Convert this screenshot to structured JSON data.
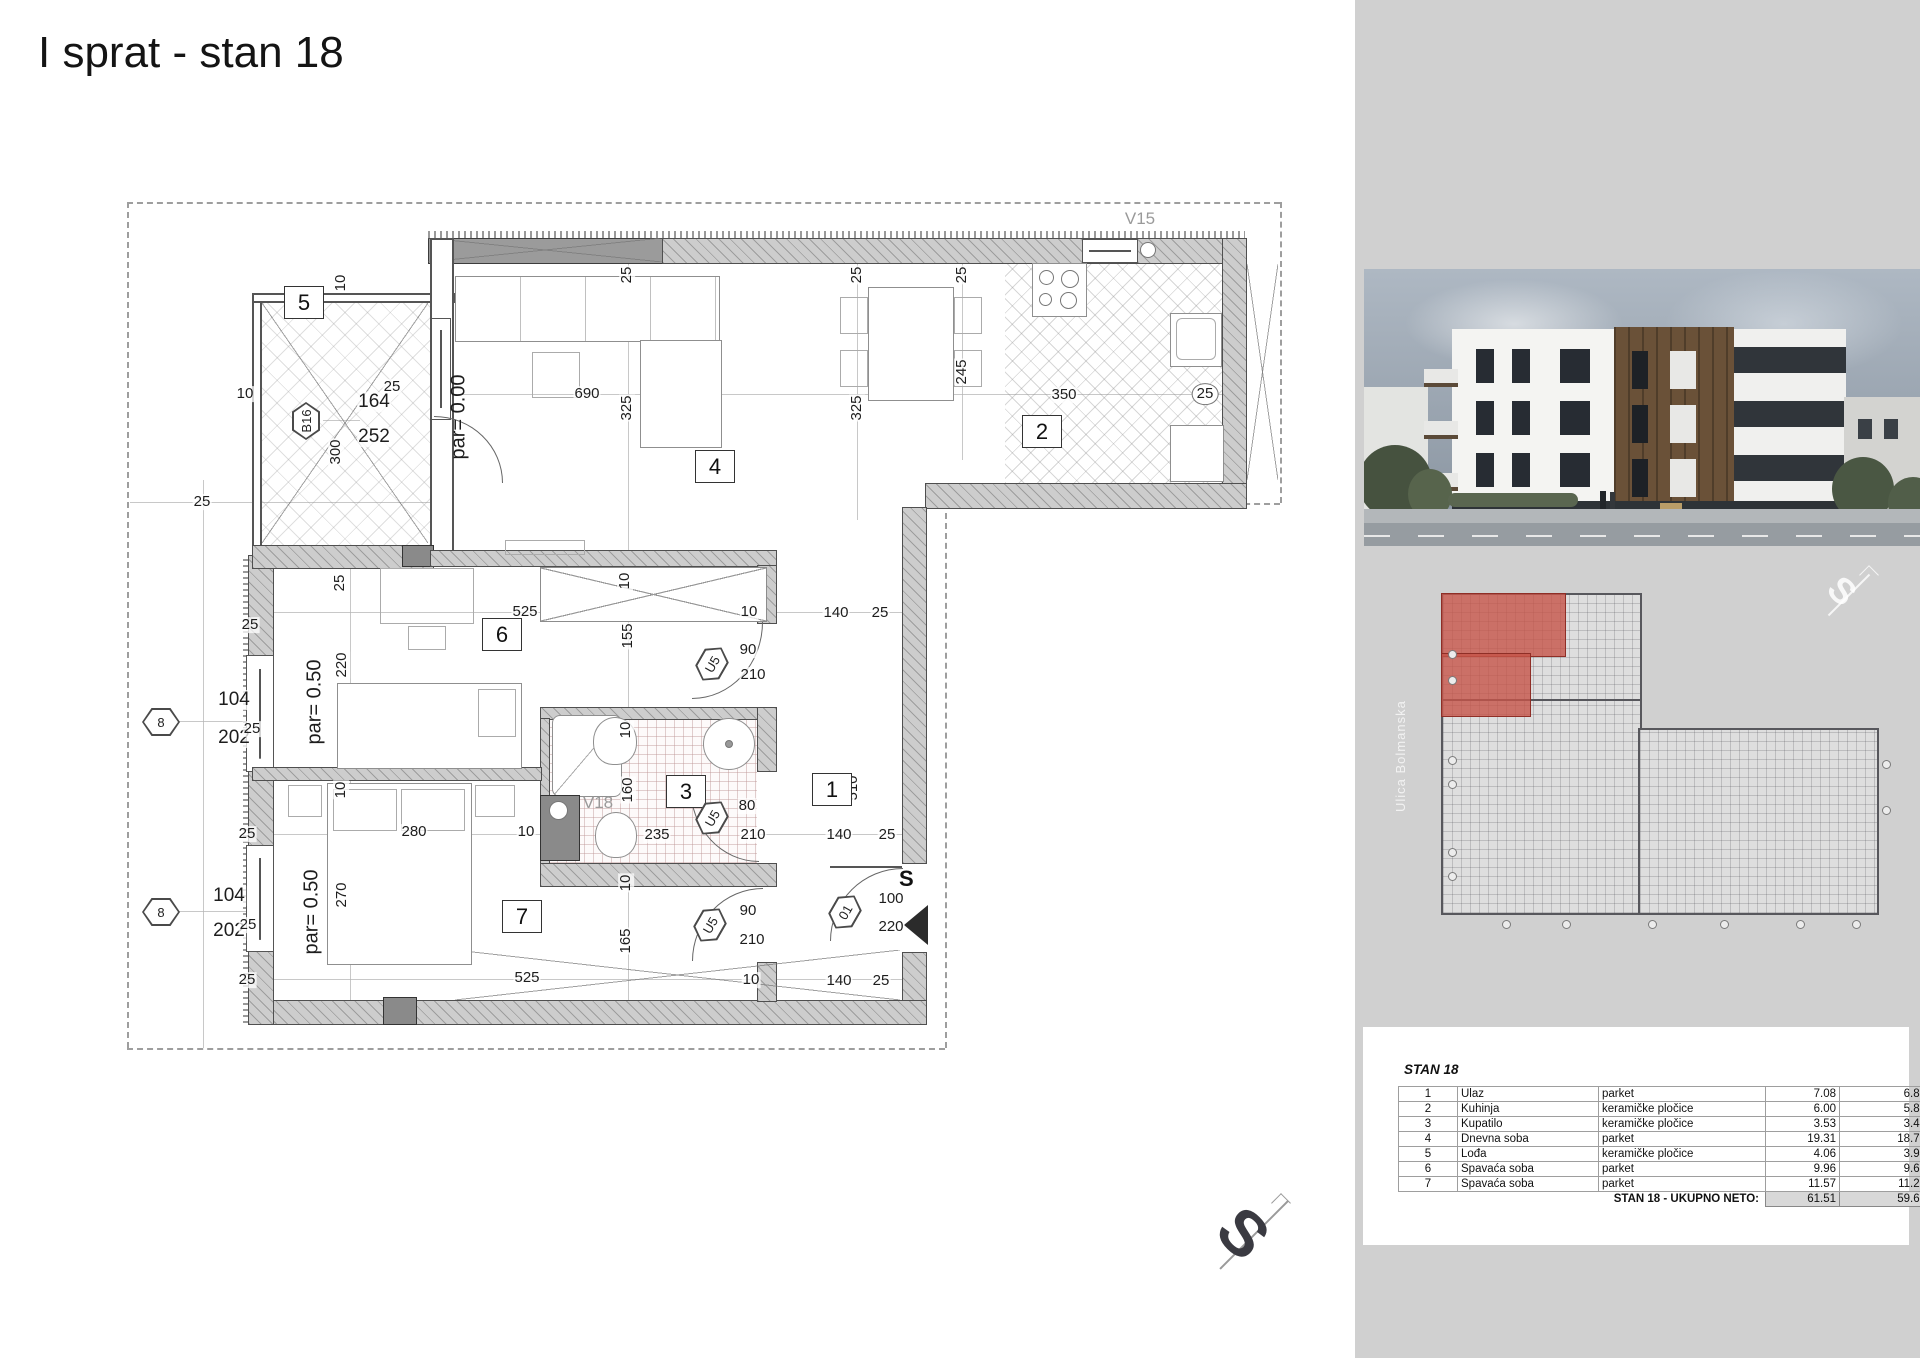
{
  "title": "I sprat - stan 18",
  "colors": {
    "highlight_red": "#c5544a",
    "panel_gray": "#d0d0d0"
  },
  "plan": {
    "window_label_top": "V15",
    "window_label_bath": "V18",
    "entry_letter": "S",
    "rooms": [
      {
        "n": "5",
        "x": 303,
        "y": 302
      },
      {
        "n": "4",
        "x": 714,
        "y": 466
      },
      {
        "n": "2",
        "x": 1041,
        "y": 431
      },
      {
        "n": "6",
        "x": 501,
        "y": 634
      },
      {
        "n": "3",
        "x": 685,
        "y": 791
      },
      {
        "n": "1",
        "x": 831,
        "y": 789
      },
      {
        "n": "7",
        "x": 521,
        "y": 916
      }
    ],
    "hexes": [
      {
        "t": "B16",
        "x": 306,
        "y": 421,
        "r": -90
      },
      {
        "t": "8",
        "x": 161,
        "y": 722,
        "r": 0
      },
      {
        "t": "8",
        "x": 161,
        "y": 912,
        "r": 0
      },
      {
        "t": "U5",
        "x": 712,
        "y": 664,
        "r": -60
      },
      {
        "t": "U5",
        "x": 712,
        "y": 818,
        "r": -60
      },
      {
        "t": "U5",
        "x": 710,
        "y": 925,
        "r": -60
      },
      {
        "t": "01",
        "x": 845,
        "y": 912,
        "r": -60
      }
    ],
    "dims": [
      {
        "t": "10",
        "x": 245,
        "y": 394,
        "r": 0
      },
      {
        "t": "10",
        "x": 341,
        "y": 283,
        "r": -90
      },
      {
        "t": "25",
        "x": 392,
        "y": 387,
        "r": 0
      },
      {
        "t": "164",
        "x": 374,
        "y": 402,
        "r": 0,
        "k": "big"
      },
      {
        "t": "252",
        "x": 374,
        "y": 437,
        "r": 0,
        "k": "big"
      },
      {
        "t": "300",
        "x": 336,
        "y": 452,
        "r": -90
      },
      {
        "t": "690",
        "x": 587,
        "y": 394,
        "r": 0
      },
      {
        "t": "25",
        "x": 627,
        "y": 275,
        "r": -90
      },
      {
        "t": "325",
        "x": 627,
        "y": 408,
        "r": -90
      },
      {
        "t": "25",
        "x": 857,
        "y": 275,
        "r": -90
      },
      {
        "t": "325",
        "x": 857,
        "y": 408,
        "r": -90
      },
      {
        "t": "25",
        "x": 962,
        "y": 275,
        "r": -90
      },
      {
        "t": "245",
        "x": 962,
        "y": 372,
        "r": -90
      },
      {
        "t": "350",
        "x": 1064,
        "y": 395,
        "r": 0
      },
      {
        "t": "25",
        "x": 1205,
        "y": 394,
        "r": 0,
        "k": "circ"
      },
      {
        "t": "25",
        "x": 202,
        "y": 502,
        "r": 0
      },
      {
        "t": "525",
        "x": 525,
        "y": 612,
        "r": 0
      },
      {
        "t": "10",
        "x": 749,
        "y": 612,
        "r": 0
      },
      {
        "t": "140",
        "x": 836,
        "y": 613,
        "r": 0
      },
      {
        "t": "25",
        "x": 880,
        "y": 613,
        "r": 0
      },
      {
        "t": "25",
        "x": 340,
        "y": 583,
        "r": -90
      },
      {
        "t": "10",
        "x": 625,
        "y": 581,
        "r": -90
      },
      {
        "t": "155",
        "x": 628,
        "y": 636,
        "r": -90
      },
      {
        "t": "220",
        "x": 342,
        "y": 665,
        "r": -90
      },
      {
        "t": "25",
        "x": 250,
        "y": 625,
        "r": 0
      },
      {
        "t": "104",
        "x": 234,
        "y": 700,
        "r": 0,
        "k": "big"
      },
      {
        "t": "202",
        "x": 234,
        "y": 738,
        "r": 0,
        "k": "big"
      },
      {
        "t": "25",
        "x": 252,
        "y": 729,
        "r": 0
      },
      {
        "t": "90",
        "x": 748,
        "y": 650,
        "r": 0
      },
      {
        "t": "210",
        "x": 753,
        "y": 675,
        "r": 0
      },
      {
        "t": "10",
        "x": 626,
        "y": 730,
        "r": -90
      },
      {
        "t": "160",
        "x": 628,
        "y": 790,
        "r": -90
      },
      {
        "t": "235",
        "x": 657,
        "y": 835,
        "r": 0
      },
      {
        "t": "80",
        "x": 747,
        "y": 806,
        "r": 0
      },
      {
        "t": "210",
        "x": 753,
        "y": 835,
        "r": 0
      },
      {
        "t": "280",
        "x": 414,
        "y": 832,
        "r": 0
      },
      {
        "t": "10",
        "x": 526,
        "y": 832,
        "r": 0
      },
      {
        "t": "140",
        "x": 839,
        "y": 835,
        "r": 0
      },
      {
        "t": "25",
        "x": 887,
        "y": 835,
        "r": 0
      },
      {
        "t": "270",
        "x": 342,
        "y": 895,
        "r": -90
      },
      {
        "t": "10",
        "x": 341,
        "y": 790,
        "r": -90
      },
      {
        "t": "104",
        "x": 229,
        "y": 896,
        "r": 0,
        "k": "big"
      },
      {
        "t": "202",
        "x": 229,
        "y": 931,
        "r": 0,
        "k": "big"
      },
      {
        "t": "25",
        "x": 248,
        "y": 925,
        "r": 0
      },
      {
        "t": "25",
        "x": 247,
        "y": 834,
        "r": 0
      },
      {
        "t": "90",
        "x": 748,
        "y": 911,
        "r": 0
      },
      {
        "t": "210",
        "x": 752,
        "y": 940,
        "r": 0
      },
      {
        "t": "100",
        "x": 891,
        "y": 899,
        "r": 0
      },
      {
        "t": "220",
        "x": 891,
        "y": 927,
        "r": 0
      },
      {
        "t": "10",
        "x": 626,
        "y": 883,
        "r": -90
      },
      {
        "t": "165",
        "x": 626,
        "y": 941,
        "r": -90
      },
      {
        "t": "525",
        "x": 527,
        "y": 978,
        "r": 0
      },
      {
        "t": "10",
        "x": 751,
        "y": 980,
        "r": 0
      },
      {
        "t": "140",
        "x": 839,
        "y": 981,
        "r": 0
      },
      {
        "t": "25",
        "x": 881,
        "y": 981,
        "r": 0
      },
      {
        "t": "25",
        "x": 247,
        "y": 980,
        "r": 0
      },
      {
        "t": "510",
        "x": 853,
        "y": 788,
        "r": -90
      },
      {
        "t": "par= 0.00",
        "x": 459,
        "y": 417,
        "r": -90,
        "k": "par"
      },
      {
        "t": "par= 0.50",
        "x": 315,
        "y": 702,
        "r": -90,
        "k": "par"
      },
      {
        "t": "par= 0.50",
        "x": 312,
        "y": 912,
        "r": -90,
        "k": "par"
      }
    ]
  },
  "compass": {
    "letter": "S"
  },
  "side": {
    "street": "Ulica Bolmanska",
    "mini_compass": "S",
    "table": {
      "title": "STAN 18",
      "rows": [
        [
          "1",
          "Ulaz",
          "parket",
          "7.08",
          "6.87"
        ],
        [
          "2",
          "Kuhinja",
          "keramičke pločice",
          "6.00",
          "5.82"
        ],
        [
          "3",
          "Kupatilo",
          "keramičke pločice",
          "3.53",
          "3.42"
        ],
        [
          "4",
          "Dnevna soba",
          "parket",
          "19.31",
          "18.73"
        ],
        [
          "5",
          "Lođa",
          "keramičke pločice",
          "4.06",
          "3.94"
        ],
        [
          "6",
          "Spavaća soba",
          "parket",
          "9.96",
          "9.66"
        ],
        [
          "7",
          "Spavaća soba",
          "parket",
          "11.57",
          "11.22"
        ]
      ],
      "total_label": "STAN 18 - UKUPNO NETO:",
      "total_values": [
        "61.51",
        "59.66"
      ]
    }
  }
}
